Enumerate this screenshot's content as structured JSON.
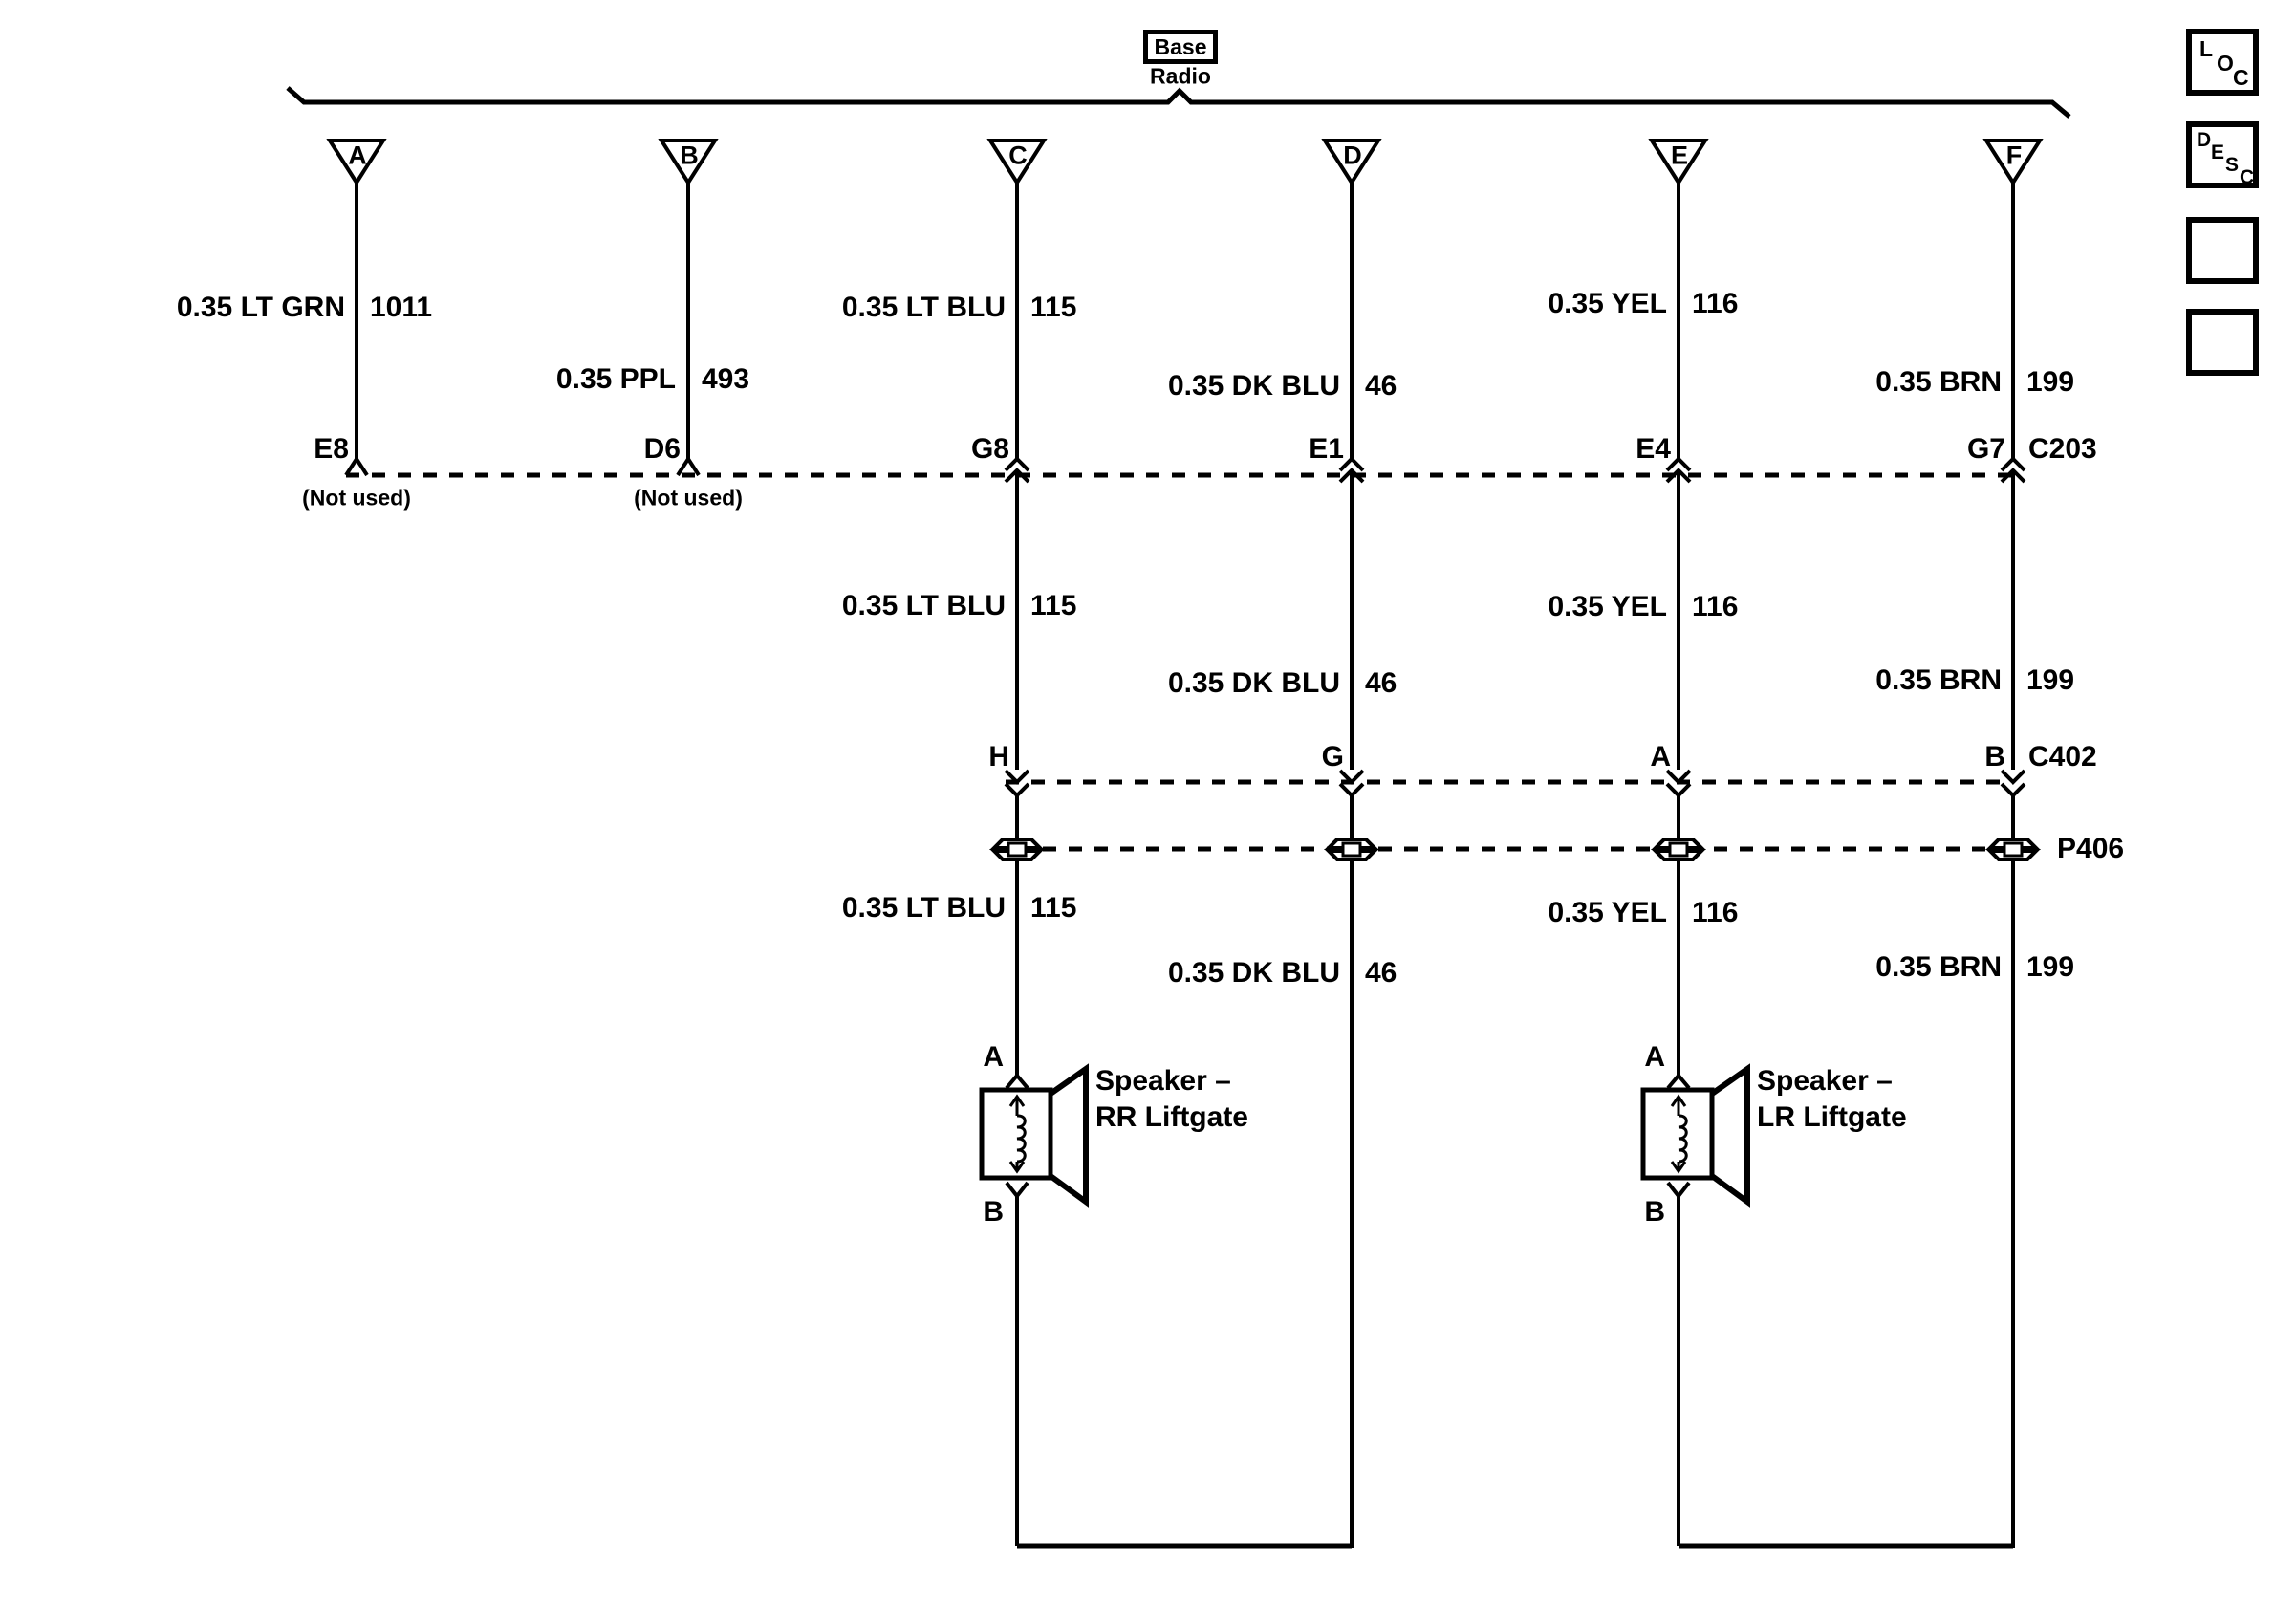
{
  "header": {
    "variant": "Base",
    "component": "Radio"
  },
  "triangles": [
    "A",
    "B",
    "C",
    "D",
    "E",
    "F"
  ],
  "wires": [
    {
      "id": "A",
      "row1": {
        "color": "0.35 LT GRN",
        "circuit": "1011"
      },
      "c203": {
        "pin": "E8",
        "note": "(Not used)"
      }
    },
    {
      "id": "B",
      "row1": {
        "color": "0.35 PPL",
        "circuit": "493"
      },
      "c203": {
        "pin": "D6",
        "note": "(Not used)"
      }
    },
    {
      "id": "C",
      "row1": {
        "color": "0.35 LT BLU",
        "circuit": "115"
      },
      "row2": {
        "color": "0.35 LT BLU",
        "circuit": "115"
      },
      "row3": {
        "color": "0.35 LT BLU",
        "circuit": "115"
      },
      "c203": {
        "pin": "G8"
      },
      "c402": {
        "pin": "H"
      }
    },
    {
      "id": "D",
      "row1": {
        "color": "0.35 DK BLU",
        "circuit": "46"
      },
      "row2": {
        "color": "0.35 DK BLU",
        "circuit": "46"
      },
      "row3": {
        "color": "0.35 DK BLU",
        "circuit": "46"
      },
      "c203": {
        "pin": "E1"
      },
      "c402": {
        "pin": "G"
      }
    },
    {
      "id": "E",
      "row1": {
        "color": "0.35 YEL",
        "circuit": "116"
      },
      "row2": {
        "color": "0.35 YEL",
        "circuit": "116"
      },
      "row3": {
        "color": "0.35 YEL",
        "circuit": "116"
      },
      "c203": {
        "pin": "E4"
      },
      "c402": {
        "pin": "A"
      }
    },
    {
      "id": "F",
      "row1": {
        "color": "0.35 BRN",
        "circuit": "199"
      },
      "row2": {
        "color": "0.35 BRN",
        "circuit": "199"
      },
      "row3": {
        "color": "0.35 BRN",
        "circuit": "199"
      },
      "c203": {
        "pin": "G7"
      },
      "c402": {
        "pin": "B"
      }
    }
  ],
  "connectors": {
    "c203": "C203",
    "c402": "C402",
    "p406": "P406"
  },
  "speakers": [
    {
      "pin_top": "A",
      "pin_bottom": "B",
      "line1": "Speaker –",
      "line2": "RR Liftgate"
    },
    {
      "pin_top": "A",
      "pin_bottom": "B",
      "line1": "Speaker –",
      "line2": "LR Liftgate"
    }
  ],
  "sidebar": {
    "loc": [
      "L",
      "O",
      "C"
    ],
    "desc": [
      "D",
      "E",
      "S",
      "C"
    ]
  }
}
